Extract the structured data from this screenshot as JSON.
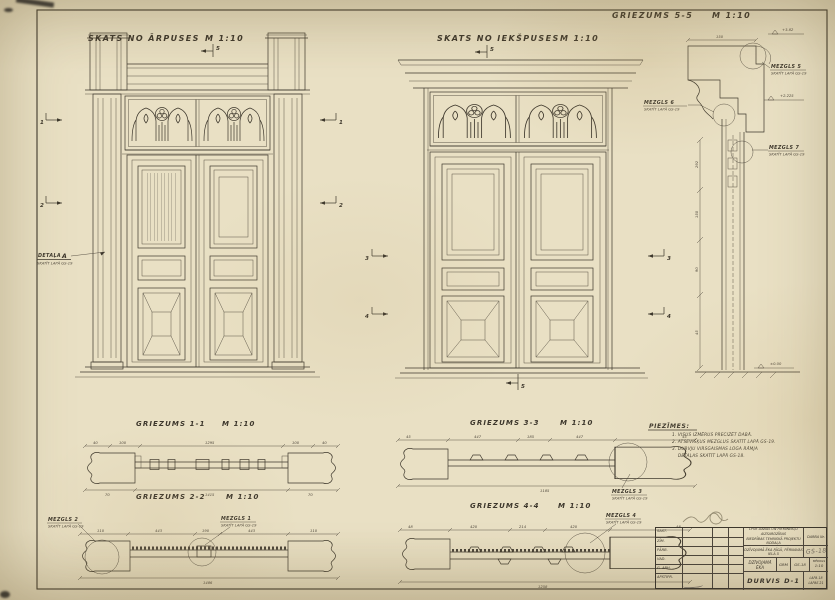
{
  "views": {
    "exterior": {
      "title": "SKATS NO ĀRPUSES",
      "scale": "M 1:10"
    },
    "interior": {
      "title": "SKATS NO IEKŠPUSES",
      "scale": "M 1:10"
    },
    "section55": {
      "title": "GRIEZUMS 5-5",
      "scale": "M 1:10"
    },
    "section11": {
      "title": "GRIEZUMS 1-1",
      "scale": "M 1:10"
    },
    "section22": {
      "title": "GRIEZUMS 2-2",
      "scale": "M 1:10"
    },
    "section33": {
      "title": "GRIEZUMS 3-3",
      "scale": "M 1:10"
    },
    "section44": {
      "title": "GRIEZUMS 4-4",
      "scale": "M 1:10"
    }
  },
  "callouts": {
    "detala_a": {
      "name": "DETAĻA",
      "letter": "A",
      "ref": "SKATĪT LAPĀ GS-19"
    },
    "mezgls1": {
      "name": "MEZGLS 1",
      "ref": "SKATĪT LAPĀ GS-19"
    },
    "mezgls2": {
      "name": "MEZGLS 2",
      "ref": "SKATĪT LAPĀ GS-19"
    },
    "mezgls3": {
      "name": "MEZGLS 3",
      "ref": "SKATĪT LAPĀ GS-19"
    },
    "mezgls4": {
      "name": "MEZGLS 4",
      "ref": "SKATĪT LAPĀ GS-19"
    },
    "mezgls5": {
      "name": "MEZGLS 5",
      "ref": "SKATĪT LAPĀ GS-19"
    },
    "mezgls6": {
      "name": "MEZGLS 6",
      "ref": "SKATĪT LAPĀ GS-19"
    },
    "mezgls7": {
      "name": "MEZGLS 7",
      "ref": "SKATĪT LAPĀ GS-19"
    }
  },
  "markers": {
    "m1": "1",
    "m2": "2",
    "m3": "3",
    "m4": "4",
    "m5": "5"
  },
  "elevations": {
    "top": "+3.82",
    "mid": "+2.225",
    "zero": "±0.00"
  },
  "notes": {
    "heading": "PIEZĪMES:",
    "line1": "1. VISUS IZMĒRUS PRECIZĒT DABĀ.",
    "line2": "2. ATSEVIŠĶUS MEZGLUS SKATĪT LAPĀ GS-19.",
    "line3": "3. DURVJU VIRSGAISMAS LOGA RĀMJA",
    "line4": "DETAĻAS SKATĪT LAPĀ GS-18."
  },
  "dims": {
    "g11": {
      "top": [
        "40",
        "100",
        "1295",
        "100",
        "40"
      ],
      "bottom": [
        "70",
        "1415",
        "70"
      ]
    },
    "g22": {
      "top": [
        "110",
        "443",
        "190",
        "443",
        "110"
      ],
      "bottom": "1486"
    },
    "g33": {
      "top": [
        "45",
        "447",
        "185",
        "447",
        "45"
      ],
      "bottom": "1185"
    },
    "g44": {
      "top": [
        "48",
        "420",
        "214",
        "420",
        "48"
      ],
      "bottom": "1258"
    },
    "s55": {
      "top": "150",
      "side": [
        "292",
        "150",
        "90",
        "45"
      ]
    }
  },
  "titleblock": {
    "org_line1": "LPSR DABAS UN PIEMINEKĻU AIZSARDZĪBAS",
    "org_line2": "BIEDRĪBAS TEHNISKĀ PROJEKTU NODAĻA",
    "job_label": "DARBA Nr.",
    "object_line": "DZĪVOJAMĀ ĒKA RĪGĀ, PĒRNAVAS IELĀ 5",
    "stamp": "GS-18",
    "building": "DZĪVOJAMĀ ĒKA",
    "stage": "GRM",
    "sheet_no": "GS-18",
    "scale_label": "MĒROGS",
    "scale_val": "1:10",
    "doc_title": "DURVIS D-1",
    "lapa": "LAPA 18",
    "lapas": "LAPAS 21",
    "rows": [
      {
        "role": "SAST."
      },
      {
        "role": "ZĪM."
      },
      {
        "role": "PĀRB."
      },
      {
        "role": "VAD."
      },
      {
        "role": "G. ARH."
      },
      {
        "role": "APSTIPR."
      }
    ]
  }
}
